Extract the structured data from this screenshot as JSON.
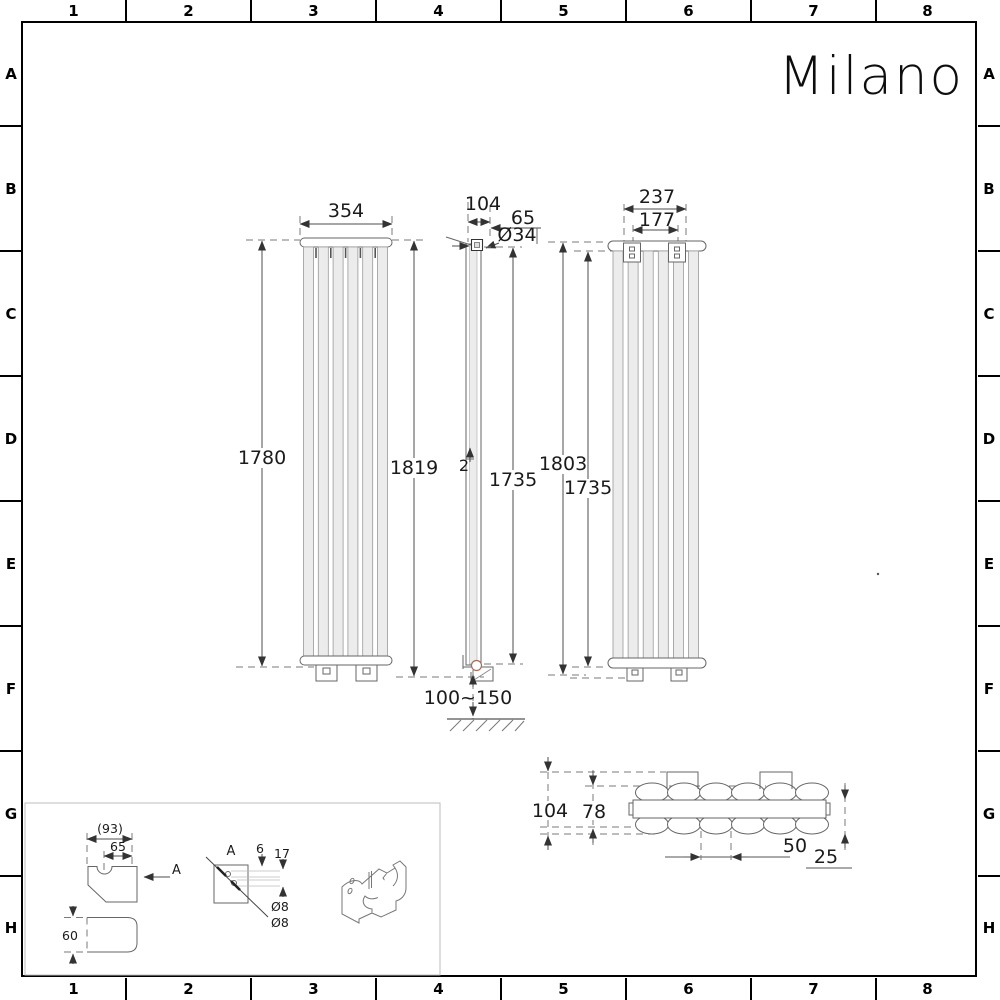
{
  "logo": "Milano",
  "grid": {
    "cols": [
      "1",
      "2",
      "3",
      "4",
      "5",
      "6",
      "7",
      "8"
    ],
    "rows": [
      "A",
      "B",
      "C",
      "D",
      "E",
      "F",
      "G",
      "H"
    ]
  },
  "views": {
    "front": {
      "width": "354",
      "height_left": "1780",
      "height_right": "1819"
    },
    "side": {
      "depth": "104",
      "offset": "65",
      "pipe_diameter": "Ø34",
      "panel_thickness": "2",
      "height": "1735",
      "floor_clearance": "100~150"
    },
    "rear": {
      "bracket_outer": "237",
      "bracket_inner": "177",
      "height": "1803",
      "column_height": "1735"
    },
    "section": {
      "depth": "104",
      "panel_spacing": "78",
      "column_pitch": "50",
      "manifold_height": "25"
    },
    "bracket": {
      "width_ref": "(93)",
      "offset": "65",
      "view_label": "A",
      "section_label": "A",
      "height": "60",
      "hole_offset": "6",
      "hole_spacing": "17",
      "hole_d1": "Ø8",
      "hole_d2": "Ø8"
    }
  }
}
